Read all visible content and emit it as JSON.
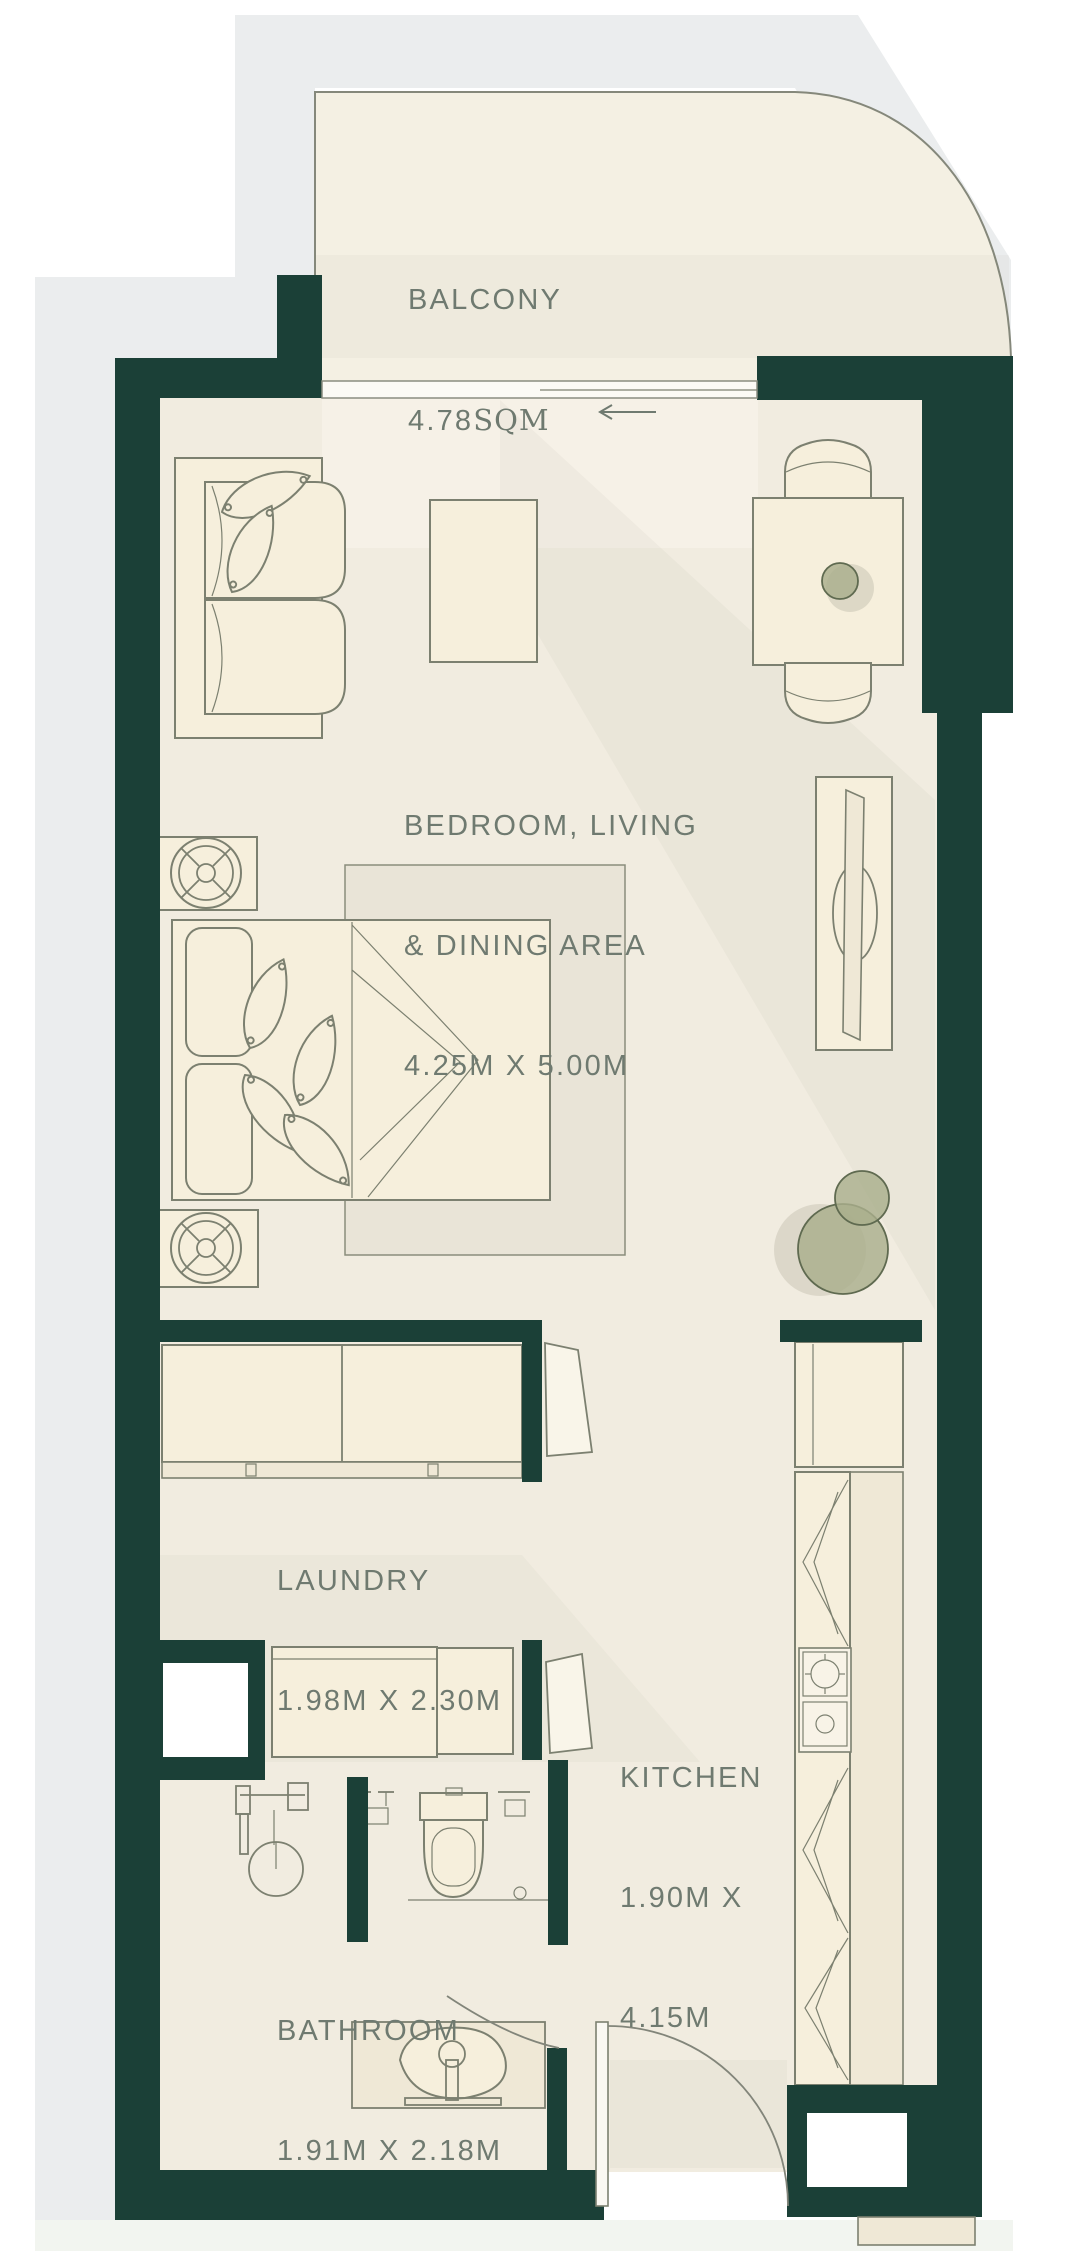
{
  "title": "Studio apartment floor plan",
  "rooms": {
    "balcony": {
      "name": "BALCONY",
      "area": "4.78",
      "area_unit": "SQM"
    },
    "bedroom": {
      "name_line1": "BEDROOM, LIVING",
      "name_line2": "& DINING AREA",
      "dims": "4.25M X 5.00M"
    },
    "laundry": {
      "name": "LAUNDRY",
      "dims": "1.98M X 2.30M"
    },
    "kitchen": {
      "name": "KITCHEN",
      "dims_line1": "1.90M X",
      "dims_line2": "4.15M"
    },
    "bathroom": {
      "name": "BATHROOM",
      "dims": "1.91M X 2.18M"
    }
  },
  "colors": {
    "wall": "#1b4037",
    "floor": "#f1ece0",
    "floor_light": "#f7f3e8",
    "balcony_floor": "#f4f0e3",
    "furniture": "#f6efdc",
    "furniture_dark": "#efe8d6",
    "outline": "#7c8070",
    "plant": "#a9ae8c",
    "plant_outline": "#5f6a50",
    "bg": "#ffffff",
    "bg_gray": "#ebedee",
    "bg_pale": "#f2f5f0",
    "label": "#6f7a70"
  }
}
